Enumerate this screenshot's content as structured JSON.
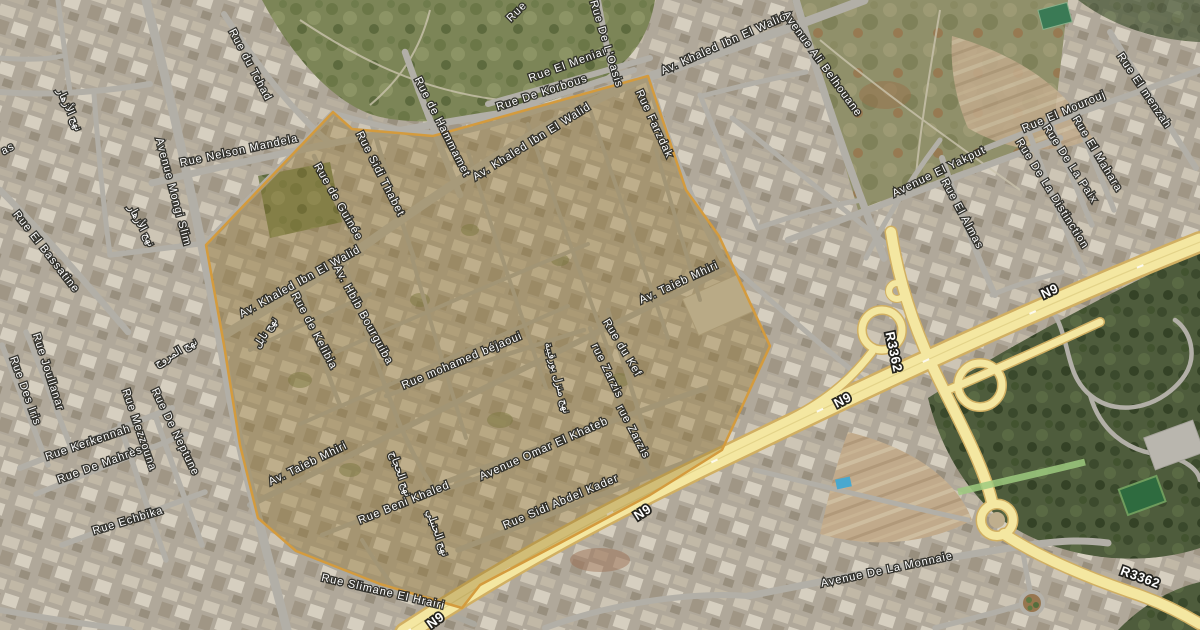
{
  "page": {
    "title": "Satellite map with highlighted district"
  },
  "map": {
    "view": "satellite",
    "highlighted_region": {
      "label": "highlighted-district",
      "border_color": "#d49b3d",
      "fill_color": "rgba(148,116,45,0.36)"
    },
    "colors": {
      "highway_fill": "#f4e7a1",
      "highway_casing": "#d1af62",
      "road_fill": "#b2afa7",
      "forest": "#4e5c3c",
      "park": "#7c8557",
      "dirt": "#c1aa8b",
      "pool": "#49a8cf",
      "label_color": "#ffffff",
      "label_halo": "#282824"
    },
    "route_labels": [
      {
        "t": "N9",
        "x": 436,
        "y": 621,
        "r": -36
      },
      {
        "t": "N9",
        "x": 643,
        "y": 513,
        "r": -33
      },
      {
        "t": "N9",
        "x": 843,
        "y": 401,
        "r": -28
      },
      {
        "t": "N9",
        "x": 1050,
        "y": 292,
        "r": -25
      },
      {
        "t": "R3362",
        "x": 893,
        "y": 352,
        "r": 78
      },
      {
        "t": "R3362",
        "x": 1140,
        "y": 578,
        "r": 20
      }
    ],
    "street_labels": [
      {
        "t": "Rue du Tchad",
        "x": 250,
        "y": 65,
        "r": 62
      },
      {
        "t": "Avenue Mongi Slim",
        "x": 173,
        "y": 192,
        "r": 75
      },
      {
        "t": "Rue Nelson Mandela",
        "x": 239,
        "y": 151,
        "r": -12
      },
      {
        "t": "Rue de Hammamet",
        "x": 442,
        "y": 127,
        "r": 63
      },
      {
        "t": "Rue El Meniar",
        "x": 568,
        "y": 65,
        "r": -20
      },
      {
        "t": "Rue De Korbous",
        "x": 542,
        "y": 93,
        "r": -18
      },
      {
        "t": "Rue De L'Oasis",
        "x": 606,
        "y": 44,
        "r": 73
      },
      {
        "t": "Av. Khaled Ibn El Walid",
        "x": 724,
        "y": 44,
        "r": -24
      },
      {
        "t": "Rue Farzdak",
        "x": 654,
        "y": 124,
        "r": 65
      },
      {
        "t": "Avenue Ali Belhouane",
        "x": 822,
        "y": 64,
        "r": 54
      },
      {
        "t": "Rue El menzah",
        "x": 1144,
        "y": 91,
        "r": 56
      },
      {
        "t": "Rue El Mourouj",
        "x": 1064,
        "y": 112,
        "r": -23
      },
      {
        "t": "Rue El Mahara",
        "x": 1097,
        "y": 154,
        "r": 59
      },
      {
        "t": "Rue De La Paix",
        "x": 1070,
        "y": 164,
        "r": 57
      },
      {
        "t": "Rue De La Distinction",
        "x": 1052,
        "y": 194,
        "r": 58
      },
      {
        "t": "Avenue El Yakput",
        "x": 939,
        "y": 172,
        "r": -26
      },
      {
        "t": "Rue El Almas",
        "x": 962,
        "y": 214,
        "r": 62
      },
      {
        "t": "Rue El Bassatine",
        "x": 46,
        "y": 252,
        "r": 52
      },
      {
        "t": "Rue Joullanar",
        "x": 48,
        "y": 372,
        "r": 72
      },
      {
        "t": "Rue Des Iris",
        "x": 25,
        "y": 391,
        "r": 70
      },
      {
        "t": "Rue Kerkennah",
        "x": 88,
        "y": 443,
        "r": -19
      },
      {
        "t": "Rue De Mahrès",
        "x": 100,
        "y": 465,
        "r": -20
      },
      {
        "t": "Rue Mezzouna",
        "x": 139,
        "y": 430,
        "r": 71
      },
      {
        "t": "Rue De Neptune",
        "x": 175,
        "y": 432,
        "r": 64
      },
      {
        "t": "Rue Echbika",
        "x": 128,
        "y": 521,
        "r": -17
      },
      {
        "t": "Avenue De La Monnaie",
        "x": 887,
        "y": 570,
        "r": -12
      },
      {
        "t": "Rue Sidi Thabet",
        "x": 380,
        "y": 174,
        "r": 63
      },
      {
        "t": "Rue de Guinée",
        "x": 338,
        "y": 202,
        "r": 60
      },
      {
        "t": "Av. Khaled Ibn El Walid",
        "x": 532,
        "y": 142,
        "r": -32
      },
      {
        "t": "Av. Khaled Ibn El Walid",
        "x": 300,
        "y": 282,
        "r": -29
      },
      {
        "t": "Rue de Kelibia",
        "x": 314,
        "y": 331,
        "r": 62
      },
      {
        "t": "Av. Hbib Bourguiba",
        "x": 363,
        "y": 315,
        "r": 61
      },
      {
        "t": "Rue mohamed béjaoui",
        "x": 462,
        "y": 361,
        "r": -23
      },
      {
        "t": "Av. Taieb Mhiri",
        "x": 679,
        "y": 283,
        "r": -25
      },
      {
        "t": "Av. Taieb Mhiri",
        "x": 308,
        "y": 464,
        "r": -26
      },
      {
        "t": "Rue du Kef",
        "x": 622,
        "y": 348,
        "r": 59
      },
      {
        "t": "rue Zarzis",
        "x": 607,
        "y": 371,
        "r": 64
      },
      {
        "t": "rue Zarzis",
        "x": 633,
        "y": 432,
        "r": 62
      },
      {
        "t": "Avenue Omar El Khateb",
        "x": 544,
        "y": 449,
        "r": -24
      },
      {
        "t": "Rue Beni Khaled",
        "x": 404,
        "y": 503,
        "r": -22
      },
      {
        "t": "Rue Sidi Abdel Kader",
        "x": 561,
        "y": 502,
        "r": -23
      },
      {
        "t": "Rue Slimane El Hrairi",
        "x": 383,
        "y": 592,
        "r": 13
      }
    ],
    "street_label_fragments": [
      {
        "t": "Rue",
        "x": 517,
        "y": 12,
        "r": -45
      },
      {
        "t": "as",
        "x": 8,
        "y": 149,
        "r": -28
      }
    ],
    "arabic_street_labels": [
      {
        "t": "نهج الأزهار",
        "x": 69,
        "y": 110,
        "r": 65
      },
      {
        "t": "نهج الأزهار",
        "x": 141,
        "y": 226,
        "r": 62
      },
      {
        "t": "نهج المروج",
        "x": 176,
        "y": 353,
        "r": -30
      },
      {
        "t": "نهج نابل",
        "x": 266,
        "y": 333,
        "r": -57
      },
      {
        "t": "نهج منزل بورقيبة",
        "x": 557,
        "y": 378,
        "r": 75
      },
      {
        "t": "نهج الحجاج",
        "x": 400,
        "y": 474,
        "r": 70
      },
      {
        "t": "نهج الحنبلي",
        "x": 437,
        "y": 533,
        "r": 70
      }
    ]
  }
}
